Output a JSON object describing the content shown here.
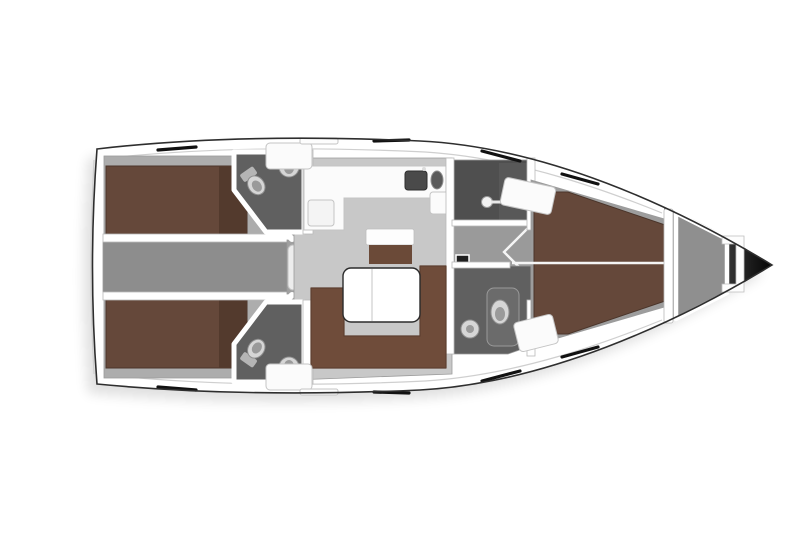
{
  "diagram": {
    "type": "yacht-interior-floorplan",
    "view": "top-down",
    "bow_direction": "right",
    "stern_direction": "left",
    "counts": {
      "sleeping_cabins": 3,
      "heads": 3,
      "hull_windows": 8,
      "companionway_steps": 4
    }
  },
  "regions": {
    "list": [
      "stern-deck",
      "aft-cabin-port",
      "aft-cabin-starboard",
      "aft-head-port",
      "aft-head-starboard",
      "corridor-aft",
      "companionway-stairs",
      "salon",
      "galley",
      "wet-locker",
      "forward-passage",
      "forward-head",
      "forward-cabin",
      "anchor-locker",
      "bow-tip"
    ]
  },
  "furniture": {
    "list": [
      "double-bed-port",
      "double-bed-starboard",
      "v-berth",
      "l-shaped-sofa",
      "salon-table",
      "chart-table",
      "galley-counter",
      "stove",
      "sink-basin",
      "round-sink",
      "toilet",
      "washbasin",
      "shower-head",
      "steps",
      "storage-lockers"
    ]
  },
  "colors": {
    "background": "#ffffff",
    "hull_fill": "#ffffff",
    "hull_outline": "#2e2e2e",
    "shadow": "#000000",
    "aft_cabin_floor": "#adadad",
    "salon_floor": "#c8c8c8",
    "corridor_floor": "#8d8d8d",
    "stairs_floor": "#a0a0a0",
    "step_fill": "#ededed",
    "wet_room_floor": "#4f4f4f",
    "passage_floor": "#9a9a9a",
    "head_floor": "#606060",
    "fwd_cabin_floor": "#9d9d9d",
    "anchor_locker_floor": "#8f8f8f",
    "bed_brown": "#65483a",
    "bed_brown_dark": "#533a2d",
    "sofa_brown": "#6f4c3a",
    "chart_table_brown": "#6b4a38",
    "table_white": "#ffffff",
    "counter_white": "#fbfbfb",
    "locker_white": "#fbfbfb",
    "fixture_light": "#d6d6d6",
    "fixture_mid": "#9a9a9a",
    "sink_dark": "#4a4a4a",
    "door_panel": "#6b6b6b",
    "wet_panel": "#585858",
    "socket_dark": "#1f1f1f",
    "window_black": "#111111",
    "bow_mid": "#8a8a8a",
    "bow_dark": "#050505"
  }
}
